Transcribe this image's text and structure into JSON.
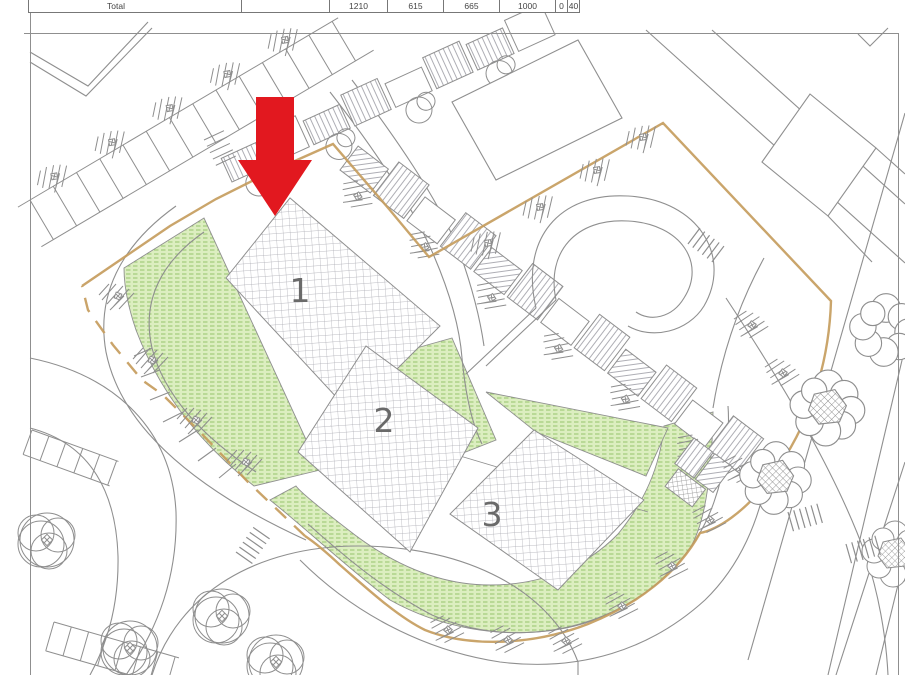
{
  "plan": {
    "summary_table": {
      "row_label": "Total",
      "values": [
        "",
        "1210",
        "615",
        "665",
        "1000",
        "0",
        "40"
      ]
    },
    "parcels": [
      {
        "label": "1"
      },
      {
        "label": "2"
      },
      {
        "label": "3"
      }
    ],
    "marker": {
      "shape": "down-arrow",
      "color": "#e2181f"
    },
    "colors": {
      "line_gray": "#8f8f8f",
      "grid_gray": "#a8a8b0",
      "green_fill": "#dceec0",
      "green_hatch": "#96c46c",
      "boundary_tan": "#c69d5e",
      "label_gray": "#6a6a6a",
      "arrow_red": "#e2181f"
    }
  }
}
